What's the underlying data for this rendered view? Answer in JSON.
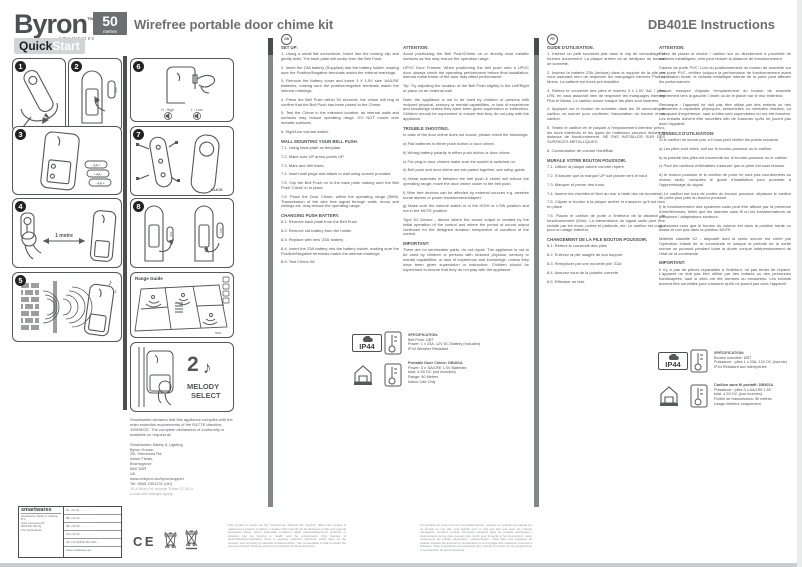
{
  "header": {
    "brand": "Byron",
    "brand_tm": "™",
    "brand_sub": "smartwares",
    "badge_value": "50",
    "badge_unit": "metres",
    "title": "Wirefree portable door chime kit",
    "model": "DB401E Instructions",
    "quick": "Quick",
    "start": "Start"
  },
  "lang": {
    "en": "GB",
    "fr": "FR"
  },
  "qs": {
    "nums": [
      "1",
      "2",
      "3",
      "4",
      "5",
      "6",
      "7",
      "8"
    ],
    "battery": "23A",
    "aa": [
      "- AA +",
      "+ AA -",
      "- AA +"
    ],
    "one_metre": "1 metre",
    "high": "H : High",
    "low": "L : Low",
    "click": "CLICK",
    "note": "♪",
    "range_title": "Range Guide",
    "range_caption": "50M",
    "melody_num": "2",
    "melody_note": "♪",
    "melody_line1": "MELODY",
    "melody_line2": "SELECT"
  },
  "columns": [
    {
      "id": "setup-en",
      "sections": [
        {
          "h": "SET UP:",
          "items": [
            "1. Using a small flat screwdriver, insert into the locking clip and gently twist. The back plate will unclip from the Bell Push.",
            "2. Insert the 23A battery (Supplied) into the battery holder, making sure the Positive/Negative terminals match the internal markings.",
            "3. Remove the battery cover and insert 3 X 1.5V size 'AA/LR6' batteries, making sure the positive/negative terminals match the internal markings.",
            "4. Press the Bell Push within 30 seconds, the chime will ring to confirm that the Bell Push has been paired to the Chime.",
            "5. Test the Chime in the intended location, as internal walls and surfaces may reduce operating range. DO NOT mount onto metallic surfaces.",
            "6. High/Low volume switch"
          ]
        },
        {
          "h": "WALL MOUNTING YOUR BELL PUSH.",
          "items": [
            "7.1. Using back plate as template.",
            "7.2. Make sure UP arrow points UP.",
            "7.3. Mark and drill holes.",
            "7.4. Insert wall plugs and attach to wall using screws provided.",
            "7.5. Clip the Bell Push on to the back plate making sure the Bell Push 'Clicks' in to place.",
            "7.6. Place the Door Chime, within the operating range (50M). Transmission of the wire free signal through walls, doors and ceilings etc, may reduce the operating range."
          ]
        },
        {
          "h": "CHANGING PUSH BATTERY.",
          "items": [
            "8.1: Remove back plate from the Bell Push",
            "8.2: Remove old battery from the holder",
            "8.3: Replace with new '23A' battery",
            "8.4: Insert the 23A battery into the battery holder, making sure the Positive/Negative terminals match the internal markings.",
            "8.5: Test Chime Kit"
          ]
        }
      ]
    },
    {
      "id": "attention-en",
      "sections": [
        {
          "h": "ATTENTION:",
          "items": [
            "Avoid positioning the Bell Push/Chime on or directly near metallic surfaces as this may reduce the operation range.",
            "UPVC Door Frames: When positioning the bell push onto a UPVC door, always check the operating performance before final installation, internal metal frame of the door may affect performance.",
            "Tip: Try adjusting the location of the Bell Push slightly to the Left/Right or place on an external wall.",
            "Note: the appliance is not to be used by children or persons with reduced physical, sensory or mental capabilities, or lack of experience and knowledge unless they have been given supervision or instruction. Children should be supervised to ensure that they do not play with the appliance."
          ]
        },
        {
          "h": "TROUBLE SHOOTING.",
          "items": [
            "In case of the door chime does not sound, please check the followings:",
            "a) Flat batteries in either push button or door chime.",
            "b) Wrong battery polarity in either push button or door chime.",
            "c) For plug-in door chimes make sure the socket is switched on.",
            "d) Bell push and door chime are not paired together, see setup guide.",
            "e) Metal materials in between the bell push & chime will reduce the operating range, move the door chime closer to the bell push",
            "f) Wire free devices can be affected by external sources e.g. wirefree home alarms or power transformers/adapter",
            "g) Make sure the volume switch is in the HIGH or LOW position and not in the MUTE position",
            "Type K2 Device - device where the sound output is created by the initial operation of the control and where the period of sound output continues for the designed duration irrespective of condition of the control."
          ]
        },
        {
          "h": "IMPORTANT:",
          "items": [
            "There are no serviceable parts, do not repair. The appliance is not to be used by children or persons with reduced physical, sensory or mental capabilities, or lack of experience and knowledge, unless they have been given supervision or instruction. Children should be supervised to ensure that they do not play with the appliance."
          ]
        }
      ]
    },
    {
      "id": "guide-fr",
      "sections": [
        {
          "h": "GUIDE D'UTILISATION.",
          "items": [
            "1. Insérez un petit tournevis plat dans le clip de verrouillage et tournez doucement. La plaque arrière va se déclipser du bouton de sonnette.",
            "2. Insérez la batterie 23A (incluse) dans le support de la pile, en vous assurant bien de respecter les marquages internes Plus et Moins. La batterie est livrée pré-installée.",
            "3. Retirez le couvercle des piles et insérez 3 x 1.5V 'AA' / piles LR6, en vous assurant bien de respecter les marquages internes Plus et Moins. Le carillon sonne lorsque les piles sont insérées.",
            "4. Appuyez sur le bouton de sonnette dans les 30 secondes, le carillon va sonner pour confirmer l'association du bouton et du carillon.",
            "5. Testez le carillon en le plaçant à l'emplacement intérieur prévu, les murs intérieurs et les types de matériaux peuvent réduire la distance de fonctionnement. NE PAS INSTALLER SUR DES SURFACES MÉTALLIQUES.",
            "6. Commutateur de volume Haut/Bas"
          ]
        },
        {
          "h": "MURALE VOTRE BOUTON POUSSOIR.",
          "items": [
            "7.1. Utiliser la plaque arrière comme repère",
            "7.2. S'assurer que la marque UP soit placée vers le haut",
            "7.3. Marquer et percer des trous.",
            "7.4. Insérer les chevilles et fixer au mur à l'aide des vis fournies",
            "7.5. Clipser le bouton à la plaque arrière et s'assurer qu'il est bien en place",
            "7.6. Placez le carillon de porte à l'intérieur de la distance de fonctionnement (50m). La transmission du signal radio peut être réduite par les murs, portes et plafonds, etc. Le carillon est conçu pour un usage intérieur."
          ]
        },
        {
          "h": "CHANGEMENT DE LA PILE BOUTON POUSSOIR.",
          "items": [
            "8.1. Retirez le couvercle des piles",
            "8.2. Enlevez la pile usagée de son support",
            "8.3. Remplacer par une nouvelle pile '23A'",
            "8.4. Assurez vous de la polarité correcte",
            "8.5. Effectuer un test."
          ]
        }
      ]
    },
    {
      "id": "attention-fr",
      "sections": [
        {
          "h": "ATTENTION:",
          "items": [
            "Évitez de placer la cloche / carillon sur ou directement à proximité de surfaces métalliques, cela peut réduire la distance de fonctionnement.",
            "Cadres de porte PVC: Lors du positionnement du bouton de sonnette sur une porte PVC, vérifiez toujours la performance de fonctionnement avant l'installation finale, le châssis métallique interne de la porte peut affecter les performances.",
            "Astuce: essayez d'ajuster l'emplacement du bouton de sonnette légèrement vers la gauche / droite ou de le placer sur le mur extérieur.",
            "Remarque : l'appareil ne doit pas être utilisé par des enfants ou des personnes à capacités physiques, sensorielles ou mentales réduites, ou manquant d'expérience, sauf si elles sont supervisées ou ont été formées. Les enfants doivent être surveillés afin de s'assurer qu'ils ne jouent pas avec l'appareil."
          ]
        },
        {
          "h": "CONSEILS D'UTILISATION:",
          "items": [
            "Si le carillon ne sonne pas, s'il vous plaît vérifier les points suivants:",
            "a) Les piles sont vides, soit sur le bouton-poussoir ou le carillon.",
            "b) la polarité des piles est incorrecte sur le bouton-poussoir ou le carillon",
            "c) Pour les carillons enfichables s'assurer que la prise est sous tension.",
            "d) le bouton poussoir et le carillon de porte ne sont pas coordonnées au niveau radio, consultez le guide d'installation pour procéder à l'apprentissage du signal.",
            "e) Le carillon est hors de portée du bouton poussoir, déplacez le carillon de porte plus près du bouton poussoir",
            "f) le fonctionnement des systèmes radio peut être affecté par la présence d'interférences, telles que les alarmes sans fil ou les transformateurs de puissance / adaptateurs secteurs.",
            "g) Assurez-vous que le bouton du volume est dans la position haute ou basse et non pas dans la position MUTE.",
            "Matériel classifié K2 - dispositif dont la sortie sonore est créée par l'opération initiale de la commande et lorsque la période de la sortie sonore se poursuit pendant toute la durée conçue indépendamment de l'état de la commande."
          ]
        },
        {
          "h": "IMPORTANT:",
          "items": [
            "Il n'y a pas de pièces réparables à l'intérieur, ne pas tenter de réparer. L'appareil ne doit pas être utilisé par des enfants ou des personnes handicapées, sauf si elles ont été formées ou encadrées. Les enfants doivent être surveillés pour s'assurer qu'ils ne jouent pas avec l'appareil."
          ]
        }
      ]
    }
  ],
  "spec_en": {
    "ip44": "IP44",
    "block1": [
      "SPECIFICATION:",
      "Bell Push: DBT",
      "Power: 1 x 23A, 12V DC Battery (Included)",
      "IP44 Weather Resistant"
    ],
    "block2": [
      "Portable Door Chime: DB401A",
      "Power: 3 x 'AA/LR6' 1.5V Batteries",
      "total: 4.5V DC (not included)",
      "Range: 50 Metres",
      "Indoor Use Only"
    ]
  },
  "spec_fr": {
    "ip44": "IP44",
    "block1": [
      "SPÉCIFICATION:",
      "Bouton sonnette: DBT",
      "Puissance : piles 1 x 23A, 12V DC (fournie)",
      "IP44 Résistant aux intempéries"
    ],
    "block2": [
      "Carillon sans fil portatif: DB401A",
      "Puissance : piles 3 x AA/LR6 1.5V",
      "total: 4.5V DC (non fournies)",
      "Portée de transmission: 50 mètres",
      "Usage intérieur uniquement"
    ]
  },
  "compliance": {
    "para": "Smartwares declares that this appliance complies with the main essential requirements of the R&TTE directive, 1999/5/CE. The complete declaration of conformity is available on request at:",
    "address": [
      "Smartwares Safety & Lighting",
      "Byron House,",
      "2B, Sherwood Rd,",
      "Aston Fields,",
      "Bromsgrove",
      "B60 3DR",
      "UK",
      "www.chbyron.eu/byronsupport",
      "Tel: 0845 2301231 (UK)"
    ],
    "support": [
      "10-4 Mon-Fri, except Thurs 12:30-4",
      "Local call charges apply"
    ]
  },
  "footer": {
    "ce_label": "CE",
    "disposal_en": "This symbol is known as the 'Crossed-out Wheelie Bin Symbol'. When this symbol is marked on a product or battery, it means that it should not be disposed of with your general household waste. Some chemicals contained within electrical/electronic products or batteries can be harmful to health and the environment. Only dispose of electrical/electronic/battery items in separate collection schemes, which cater for the recovery and recycling of materials contained within. Your co-operation is vital to ensure the success of these schemes and for the protection of the environment.",
    "disposal_fr": "Ce symbole est connu comme 'la poubelle barrée'. Lorsque ce symbole est marqué sur un produit ou une pile, cela signifie qu'il ne doit pas être jeté avec les ordures ménagères. Certains produits chimiques contenus dans les produits électriques / électroniques ou les piles peuvent être nocifs pour la santé et l'environnement. Jetez uniquement les articles électriques / électroniques / piles dans des systèmes de collecte séparés qui assurent la récupération et le recyclage des matériaux contenus à l'intérieur. Votre coopération est essentielle pour assurer le succès de ces programmes et la protection de l'environnement."
  },
  "card": {
    "brand": "smartwares",
    "left": [
      "Smartwares Safety & Lighting B.V.",
      "Jules Verneweg 87",
      "5015 BH Tilburg",
      "The Netherlands"
    ],
    "rows": [
      "NL  +31 (0)·· ··· ····",
      "BE  +32 (0)· ··· ·· ··",
      "DE  +49 (0)··· ·······",
      "FR  +33 (0)· ·· ·· ·· ··",
      "UK  +44 (0)845 230 1231",
      "www.smartwares.eu"
    ]
  }
}
